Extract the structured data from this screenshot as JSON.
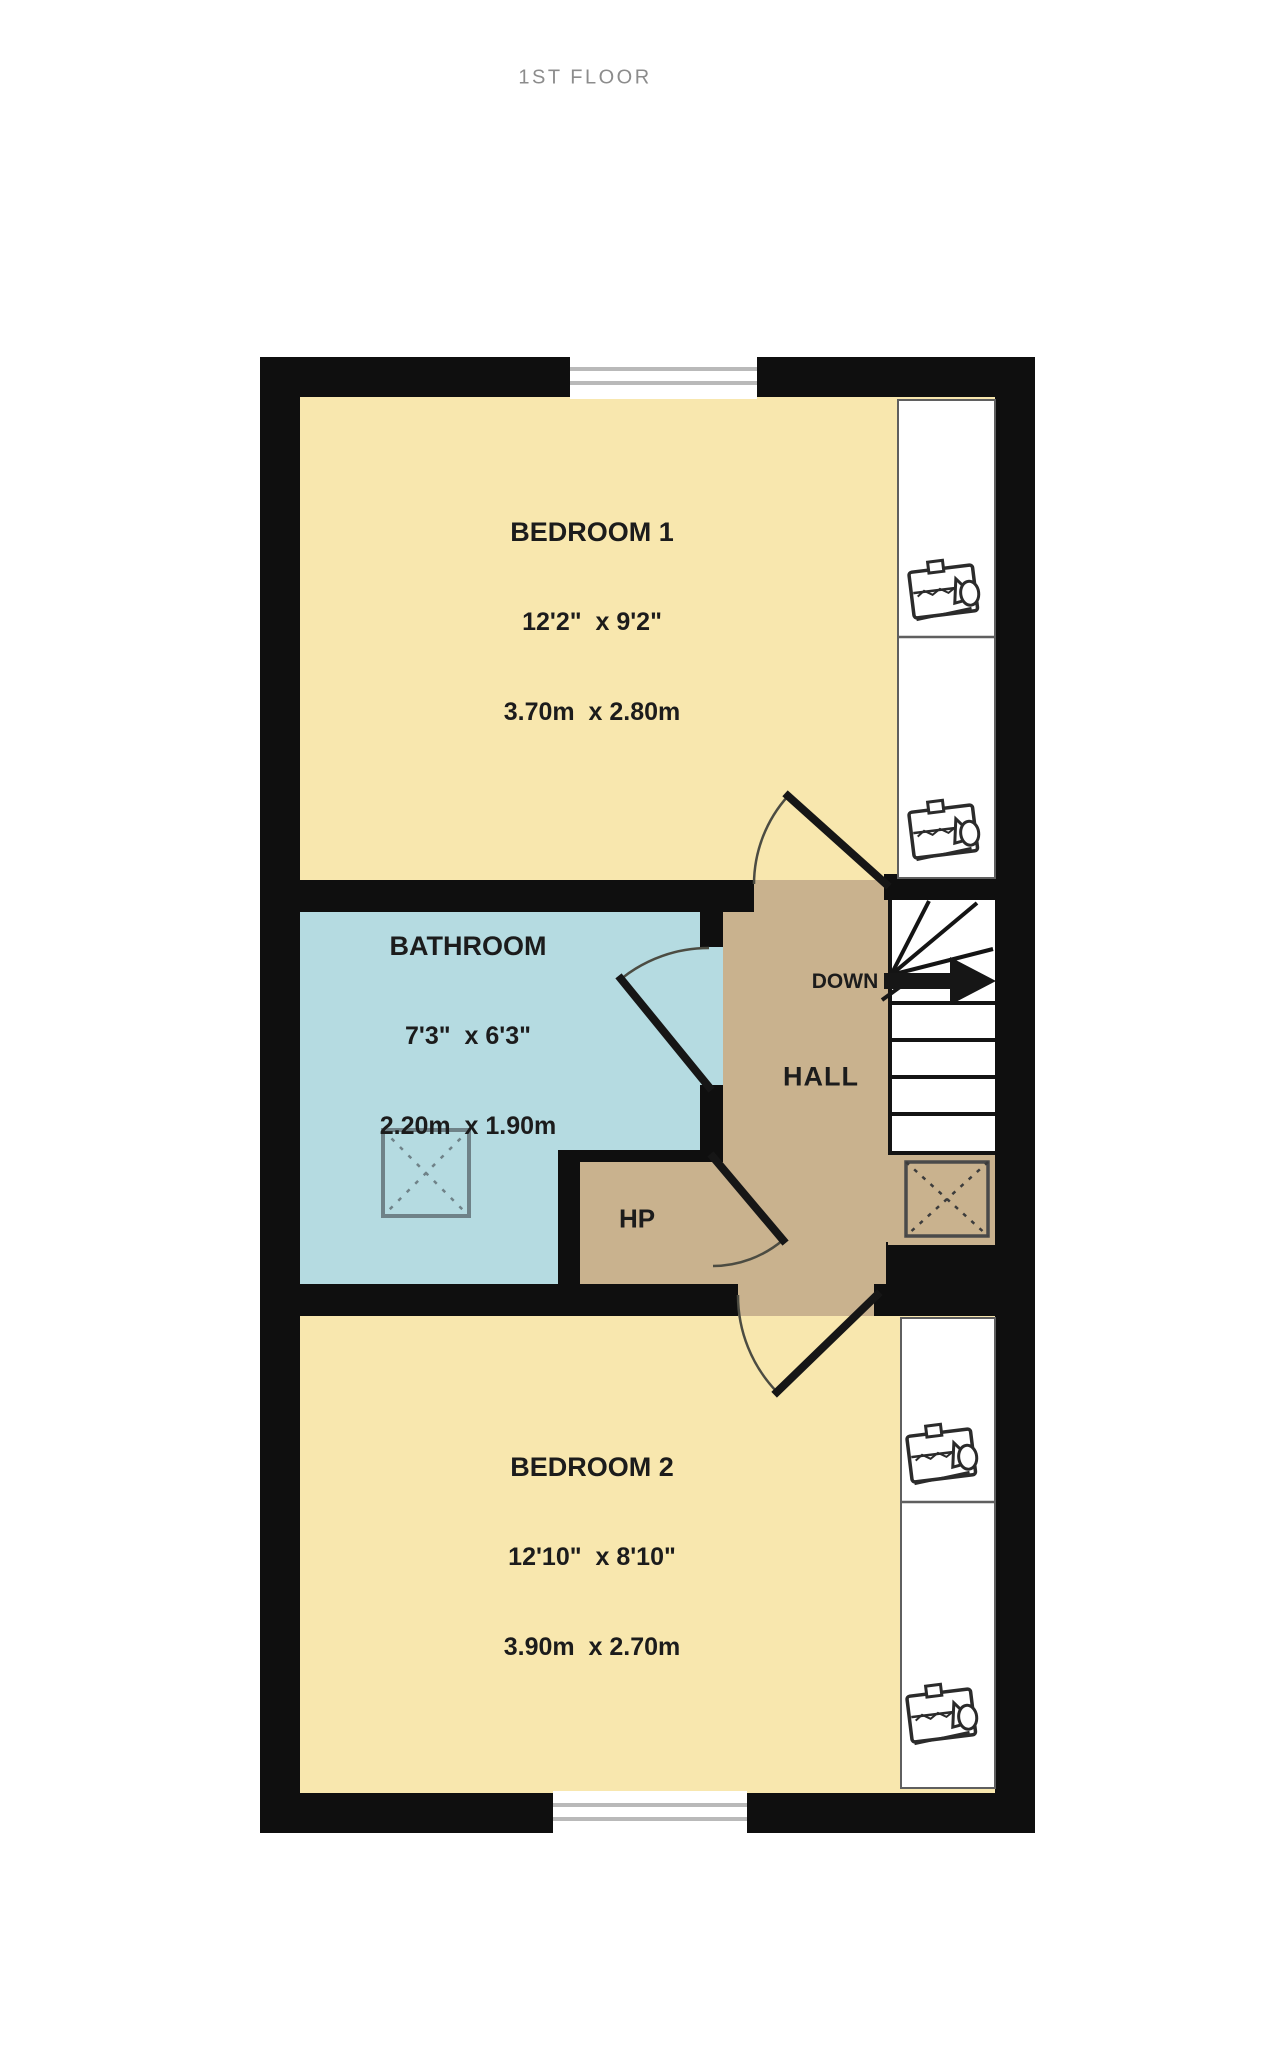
{
  "title": "1ST FLOOR",
  "colors": {
    "wall": "#0f0f0f",
    "bedroom": "#f8e7ae",
    "bathroom": "#b5dbe1",
    "hall": "#c9b28e",
    "window": "#ffffff",
    "label_text": "#1c1c1c",
    "title_text": "#8c8c8c"
  },
  "rooms": {
    "bedroom1": {
      "name": "BEDROOM 1",
      "imperial": "12'2\"  x 9'2\"",
      "metric": "3.70m  x 2.80m"
    },
    "bathroom": {
      "name": "BATHROOM",
      "imperial": "7'3\"  x 6'3\"",
      "metric": "2.20m  x 1.90m"
    },
    "hall": {
      "name": "HALL"
    },
    "hp": {
      "name": "HP"
    },
    "bedroom2": {
      "name": "BEDROOM 2",
      "imperial": "12'10\"  x 8'10\"",
      "metric": "3.90m  x 2.70m"
    }
  },
  "stairs": {
    "direction_label": "DOWN"
  }
}
